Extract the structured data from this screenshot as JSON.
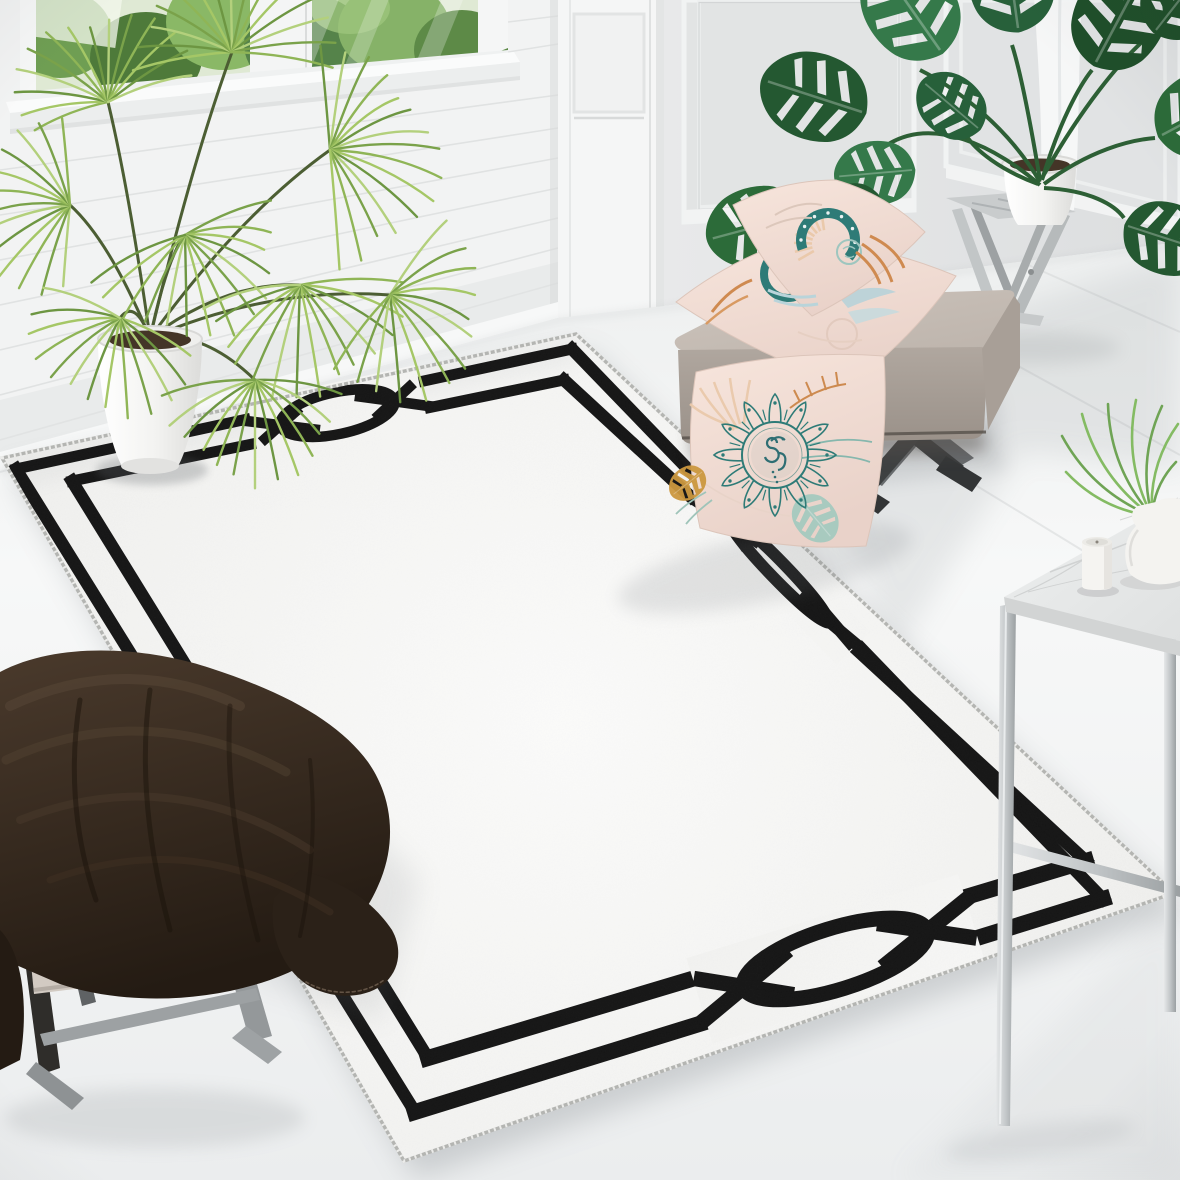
{
  "meta": {
    "alt": "Bright living room product photo: white area rug with a black double-line frame border and oval link motifs, fan palm in a white pot by a window, monstera on a gray folding stool, beige ottoman bench with pink botanical-print pillows, pink mandala pillow leaning on the rug, marble side table with candle and vase, and a beige footstool draped with a dark brown fluffy blanket."
  },
  "palette": {
    "rug_field_center": "#fbfbfa",
    "rug_field_edge": "#f0f0ee",
    "rug_border": "#161616",
    "rug_selvedge": "#b4b5b2",
    "floor_near": "#f7f8f8",
    "floor_far": "#ebedee",
    "wall_left": "#f2f3f3",
    "wall_right_light": "#e8e9ea",
    "wall_right_dark": "#dcdedf",
    "pilaster": "#f5f6f6",
    "baseboard": "#f7f8f8",
    "window_foliage_dark": "#4e7a3a",
    "window_foliage_mid": "#6f9e53",
    "window_foliage_light": "#8ab866",
    "glass_tint": "#dfe9d4",
    "palm_green_light": "#a5c766",
    "palm_green_mid": "#8fb556",
    "palm_green_dark": "#6d9642",
    "ceramic_pot": "#f3f3f1",
    "monstera_green": "#2c6b39",
    "monstera_green_dark": "#245831",
    "monstera_green_light": "#35794a",
    "stool_wood": "#c9cccd",
    "bench_top_light": "#ccc3bb",
    "bench_top_dark": "#bdb4ac",
    "bench_front_light": "#b0a79f",
    "bench_front_dark": "#9a9189",
    "bench_leg": "#3a3c3d",
    "pillow_light": "#f7e5dc",
    "pillow_dark": "#e9d2c9",
    "print_teal": "#2e7b77",
    "print_teal_light": "#9ec6bf",
    "print_orange": "#cf8a50",
    "print_peach": "#eac9ab",
    "print_blue": "#b9d4da",
    "print_aqua": "#a5cabf",
    "print_mustard": "#cc983f",
    "blanket_light": "#4a3a2c",
    "blanket_dark": "#241b13",
    "footstool_cushion": "#d2cac2",
    "footstool_leg": "#94989a",
    "chrome_light": "#e6e8e9",
    "chrome_dark": "#9ba0a2",
    "marble_light": "#eef0f0",
    "marble_dark": "#dfe1e1",
    "candle_white": "#f5f4f1",
    "soil": "#443527",
    "shadow": "#7d8488"
  },
  "rug": {
    "selvedge_quad": [
      [
        2,
        458
      ],
      [
        576,
        334
      ],
      [
        1174,
        893
      ],
      [
        404,
        1161
      ]
    ],
    "edges": [
      {
        "outer": [
          [
            16,
            469
          ],
          [
            572,
            349
          ]
        ],
        "inner": [
          [
            72,
            481
          ],
          [
            564,
            380
          ]
        ],
        "width": 11,
        "motifs": [
          {
            "f": 0.56,
            "h": 88
          }
        ]
      },
      {
        "outer": [
          [
            572,
            349
          ],
          [
            1103,
            899
          ]
        ],
        "inner": [
          [
            564,
            380
          ],
          [
            1086,
            861
          ]
        ],
        "width": 12.5,
        "motifs": [
          {
            "f": 0.4,
            "h": 110
          }
        ]
      },
      {
        "outer": [
          [
            1103,
            899
          ],
          [
            415,
            1112
          ]
        ],
        "inner": [
          [
            1086,
            861
          ],
          [
            428,
            1058
          ]
        ],
        "width": 16,
        "motifs": [
          {
            "f": 0.385,
            "h": 145
          }
        ]
      },
      {
        "outer": [
          [
            16,
            469
          ],
          [
            415,
            1112
          ]
        ],
        "inner": [
          [
            72,
            481
          ],
          [
            428,
            1058
          ]
        ],
        "width": 12.5,
        "motifs": [
          {
            "f": 0.5,
            "h": 105
          }
        ]
      }
    ]
  },
  "scene": {
    "objects": [
      {
        "name": "area-rug",
        "desc": "white rug, black geometric frame border with oval link motifs"
      },
      {
        "name": "window",
        "desc": "white framed window with green foliage outside"
      },
      {
        "name": "left-wall-shiplap",
        "desc": "white horizontal plank wall"
      },
      {
        "name": "right-wall-panels",
        "desc": "gray wall with classical recessed moldings"
      },
      {
        "name": "palm-plant",
        "desc": "fan palm in white tapered pot"
      },
      {
        "name": "monstera-plant",
        "desc": "monstera in white pot on folding stool"
      },
      {
        "name": "folding-stool",
        "desc": "weathered gray wood folding stool"
      },
      {
        "name": "ottoman-bench",
        "desc": "beige upholstered bench with dark X legs"
      },
      {
        "name": "pillow-stack",
        "desc": "two pink pillows with teal crescent print"
      },
      {
        "name": "mandala-pillow",
        "desc": "pink pillow with teal mandala and leaves"
      },
      {
        "name": "side-table",
        "desc": "marble top chrome frame table"
      },
      {
        "name": "candle",
        "desc": "white pillar candle"
      },
      {
        "name": "vase",
        "desc": "white vase with green fern"
      },
      {
        "name": "footstool",
        "desc": "beige cushioned stool with gray legs"
      },
      {
        "name": "fur-blanket",
        "desc": "dark brown fluffy throw blanket"
      },
      {
        "name": "curtain",
        "desc": "white curtain fold behind plant"
      }
    ]
  }
}
